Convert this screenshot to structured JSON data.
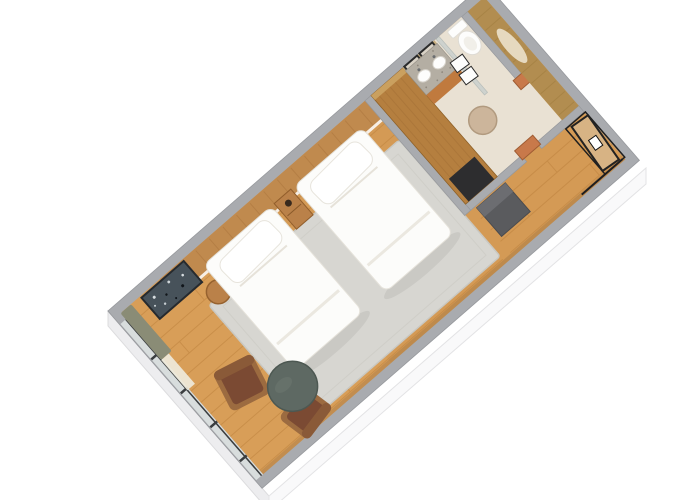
{
  "scene": {
    "description": "Isometric 3D floor plan render of a hotel twin room with two beds, seating area, bathroom with double vanity and shower, closet niche and entry door"
  },
  "colors": {
    "background": "#ffffff",
    "wallTop": "#a9abaf",
    "wallFaceSW": "#ededef",
    "wallFaceSE": "#f9f9fa",
    "floorWood": "#d49a55",
    "plankLine": "#bd823e",
    "bathFloor": "#e9e1d3",
    "closetWood": "#b28d50",
    "rug": "#d7d6d1",
    "duvet": "#fcfcfa",
    "pillow": "#ffffff",
    "headboardWood": "#c08a4e",
    "artwork": "#47525a",
    "caseWood": "#ba8149",
    "wardrobeWood": "#b57f3f",
    "copper": "#c8794a",
    "counterTerrazzo": "#b4aea3",
    "vanityCabinet": "#c07a3e",
    "mirrorGlass": "#d9d2c6",
    "mirrorFrame": "#2b2b2b",
    "stoolBeige": "#ccb59b",
    "porcelainWhite": "#fdfdfc",
    "showerGlass": "#b9c7ca",
    "benchGray": "#5a5b5e",
    "benchTopGray": "#6c6d71",
    "darkBox": "#2d2d2f",
    "chairWood": "#9c6b40",
    "chairLeather": "#7b4a33",
    "tableSage": "#5e6963",
    "curtainOlive": "#8a8c76",
    "curtainSheer": "#efeadb",
    "windowGlass": "#d8dddd",
    "windowFrame": "#3a3d3f",
    "doorWood": "#d7b384",
    "doorFrame": "#1f1f1f",
    "doorSign": "#ffffff",
    "towelWhite": "#fdfdfc"
  }
}
